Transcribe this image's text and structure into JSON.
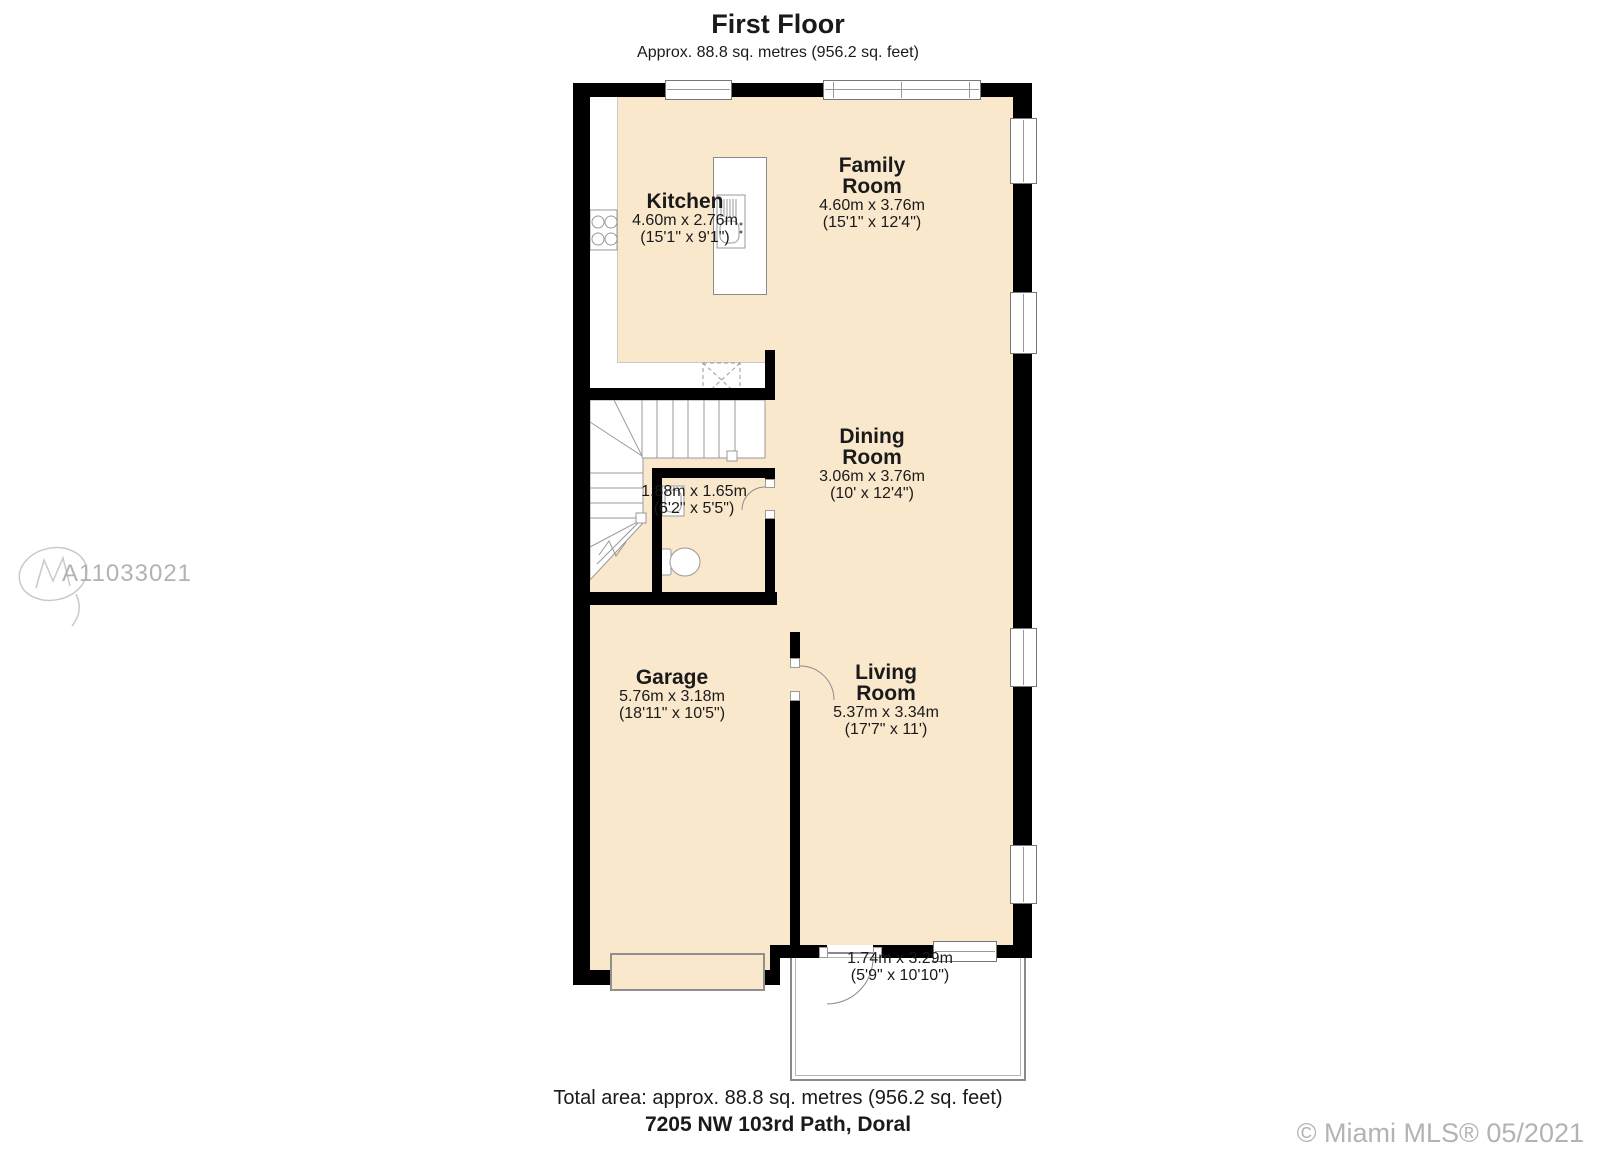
{
  "header": {
    "title": "First Floor",
    "subtitle": "Approx. 88.8 sq. metres (956.2 sq. feet)"
  },
  "rooms": [
    {
      "id": "kitchen",
      "name": "Kitchen",
      "metric": "4.60m x 2.76m",
      "imperial": "(15'1\" x 9'1\")"
    },
    {
      "id": "family-room",
      "name": "Family Room",
      "metric": "4.60m x 3.76m",
      "imperial": "(15'1\" x 12'4\")"
    },
    {
      "id": "dining-room",
      "name": "Dining Room",
      "metric": "3.06m x 3.76m",
      "imperial": "(10' x 12'4\")"
    },
    {
      "id": "wc",
      "name": "",
      "metric": "1.88m x 1.65m",
      "imperial": "(6'2\" x 5'5\")"
    },
    {
      "id": "garage",
      "name": "Garage",
      "metric": "5.76m x 3.18m",
      "imperial": "(18'11\" x 10'5\")"
    },
    {
      "id": "living-room",
      "name": "Living Room",
      "metric": "5.37m x 3.34m",
      "imperial": "(17'7\" x 11')"
    },
    {
      "id": "patio",
      "name": "",
      "metric": "1.74m x 3.29m",
      "imperial": "(5'9\" x 10'10\")"
    }
  ],
  "footer": {
    "total_area": "Total area: approx. 88.8 sq. metres (956.2 sq. feet)",
    "address": "7205 NW 103rd Path, Doral"
  },
  "watermarks": {
    "mls_id": "A11033021",
    "copyright": "© Miami MLS® 05/2021"
  },
  "colors": {
    "floor": "#fae8cd",
    "wall": "#000000",
    "outline": "#8a8a8a",
    "watermark": "#b3b3b3"
  }
}
